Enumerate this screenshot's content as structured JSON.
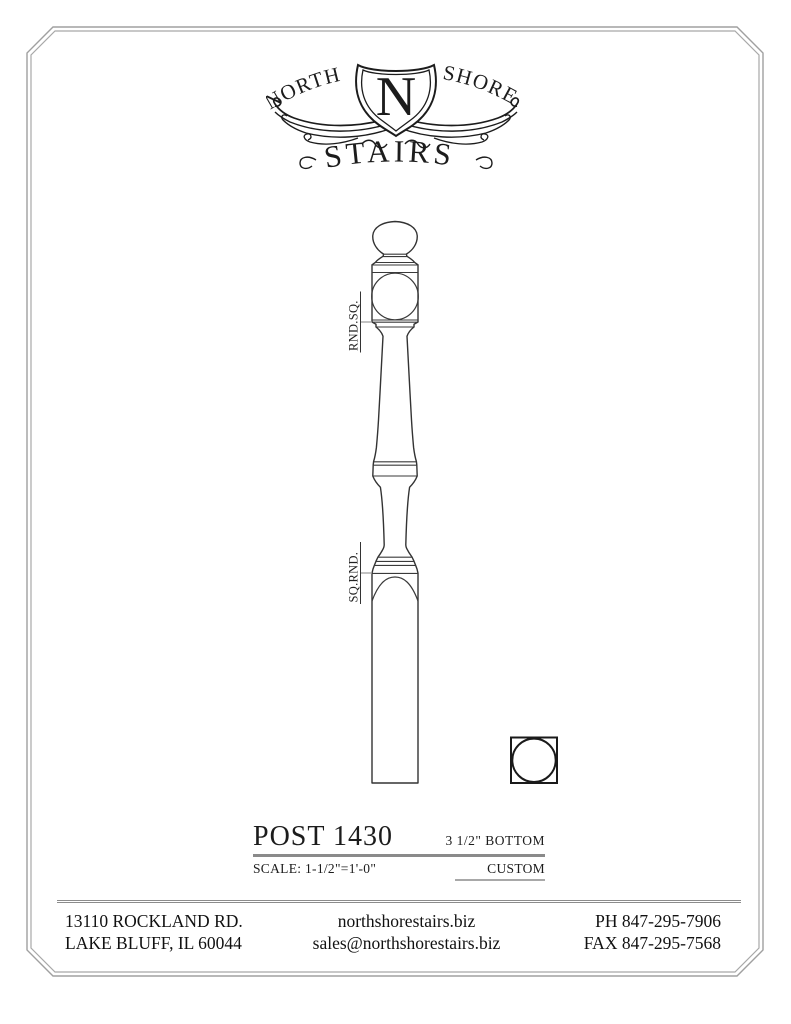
{
  "logo": {
    "word_left": "NORTH",
    "word_right": "SHORE",
    "monogram": "N",
    "word_bottom": "STAIRS"
  },
  "drawing": {
    "top_transition_label": "RND.SQ.",
    "bottom_transition_label": "SQ.RND."
  },
  "title_block": {
    "title": "POST 1430",
    "bottom_size": "3 1/2\" BOTTOM",
    "scale": "SCALE: 1-1/2\"=1'-0\"",
    "category": "CUSTOM"
  },
  "footer": {
    "address_line1": "13110 ROCKLAND RD.",
    "address_line2": "LAKE BLUFF, IL 60044",
    "website": "northshorestairs.biz",
    "email": "sales@northshorestairs.biz",
    "phone": "PH 847-295-7906",
    "fax": "FAX 847-295-7568"
  },
  "colors": {
    "ink": "#1c1c1c",
    "frame": "#a0a0a0",
    "rule": "#8a8a8a"
  }
}
